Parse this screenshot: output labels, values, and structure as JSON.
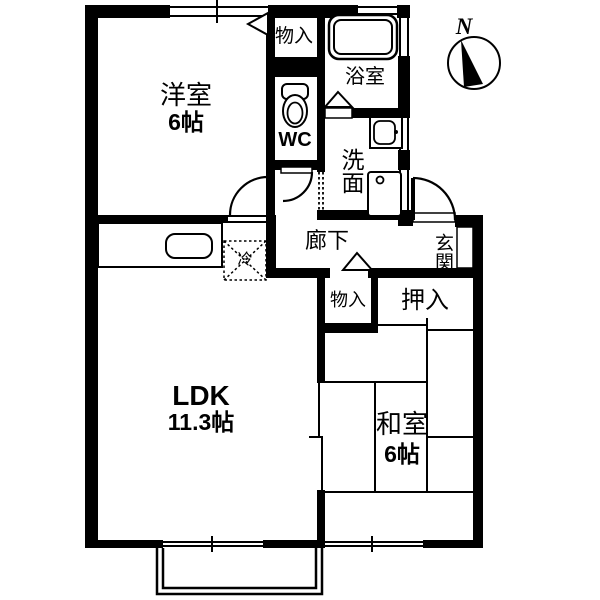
{
  "floorplan": {
    "background_color": "#ffffff",
    "line_color": "#000000",
    "compass": {
      "label": "N"
    },
    "rooms": {
      "western_room": {
        "name": "洋室",
        "size": "6帖"
      },
      "storage_top": {
        "name": "物入"
      },
      "bathroom": {
        "name": "浴室"
      },
      "toilet": {
        "name": "WC"
      },
      "washroom": {
        "name": "洗面"
      },
      "hallway": {
        "name": "廊下"
      },
      "entrance": {
        "name": "玄関"
      },
      "storage_lower": {
        "name": "物入"
      },
      "closet": {
        "name": "押入"
      },
      "refrigerator": {
        "name": "冷"
      },
      "ldk": {
        "name": "LDK",
        "size": "11.3帖"
      },
      "japanese_room": {
        "name": "和室",
        "size": "6帖"
      }
    }
  }
}
